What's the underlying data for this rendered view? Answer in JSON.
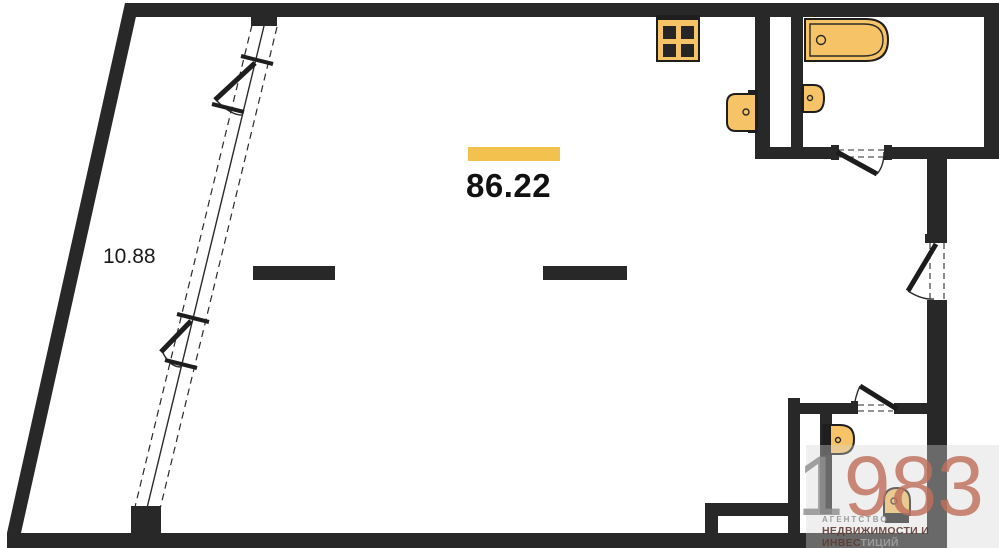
{
  "plan": {
    "main_area_label": "86.22",
    "balcony_area_label": "10.88"
  },
  "watermark": {
    "digits_gray": "1",
    "digits_colored": "983",
    "agency_line": "АГЕНТСТВО",
    "tagline_colored": "НЕДВИЖИМОСТИ И ИНВЕС",
    "tagline_gray": "ТИЦИЙ"
  },
  "icons": {
    "stove": "stove-icon",
    "kitchen_sink": "sink-icon",
    "bathtub": "bathtub-icon",
    "bathroom_sink": "sink-icon",
    "wc_sink": "sink-icon",
    "toilet": "toilet-icon",
    "doors": "door-swing-icon",
    "windows": "casement-window-icon"
  },
  "colors": {
    "wall": "#282828",
    "accent": "#F2C14E",
    "fixture": "#F6C466",
    "wm_red": "#C0715C",
    "wm_gray": "#9B9B9B",
    "wm_dark_red": "#5F3C34"
  }
}
